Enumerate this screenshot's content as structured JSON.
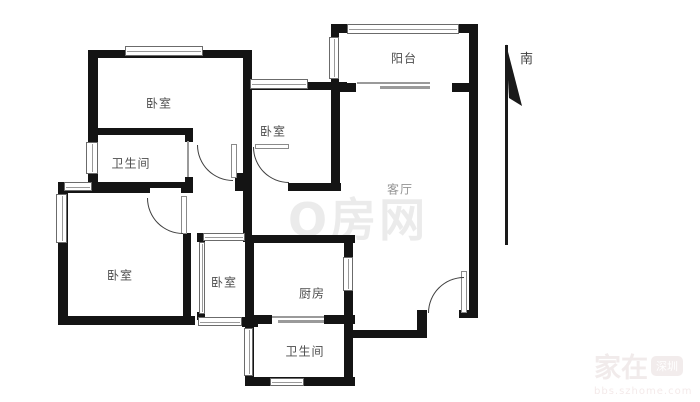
{
  "plan_title": "apartment-floor-plan",
  "rooms": {
    "bedroom_top_left": {
      "label": "卧室"
    },
    "bathroom_top": {
      "label": "卫生间"
    },
    "bedroom_middle": {
      "label": "卧室"
    },
    "balcony": {
      "label": "阳台"
    },
    "living_room": {
      "label": "客厅"
    },
    "bedroom_bottom_left": {
      "label": "卧室"
    },
    "bedroom_bottom_middle": {
      "label": "卧室"
    },
    "kitchen": {
      "label": "厨房"
    },
    "bathroom_bottom": {
      "label": "卫生间"
    }
  },
  "compass": {
    "south_label": "南"
  },
  "watermarks": {
    "center": {
      "text": "Q房网"
    },
    "corner": {
      "brand": "家在",
      "badge": "深圳",
      "url": "bbs.szhome.com"
    }
  },
  "colors": {
    "wall": "#141414",
    "thin_line": "#9a9a9a",
    "room_label": "#4d4d4d",
    "watermark_center": "#ebebeb",
    "watermark_corner": "#f1ebeb"
  }
}
